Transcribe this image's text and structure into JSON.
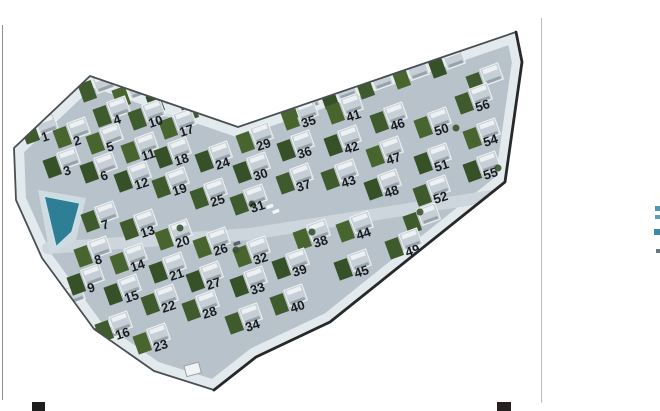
{
  "page": {
    "background": "#ffffff",
    "left_rule": {
      "x": 2,
      "y1": 25,
      "y2": 400,
      "color": "#8f8f8f"
    },
    "right_rule": {
      "x": 541,
      "y1": 18,
      "y2": 403,
      "color": "#bdbdbd"
    },
    "crop_marks": [
      {
        "x": 32,
        "y": 402,
        "w": 13,
        "h": 9,
        "color": "#1e1e1e"
      },
      {
        "x": 497,
        "y": 402,
        "w": 14,
        "h": 9,
        "color": "#262020"
      }
    ],
    "edge_fragments": [
      {
        "x": 655,
        "y": 206,
        "w": 5,
        "h": 5,
        "color": "#4e9aad"
      },
      {
        "x": 655,
        "y": 215,
        "w": 5,
        "h": 4,
        "color": "#5aa2b2"
      },
      {
        "x": 654,
        "y": 229,
        "w": 6,
        "h": 6,
        "color": "#3d8ba0"
      },
      {
        "x": 656,
        "y": 249,
        "w": 4,
        "h": 4,
        "color": "#6b7680"
      }
    ]
  },
  "site_plan": {
    "kind": "aerial-photo-of-villa-development",
    "colors": {
      "paving": "#b7c2ca",
      "paving_light": "#cdd7dd",
      "glow": "#e3eaee",
      "plaza": "#d5dee3",
      "road_light": "#ccd6dc",
      "border": "#4a4f54",
      "border_dark": "#26282a",
      "house": "#c6cfd5",
      "house_trim": "#edf1f3",
      "house_shadow": "#97a2aa",
      "gardens": [
        "#3f5a2d",
        "#49652f",
        "#365128"
      ],
      "pool": "#2e7e95",
      "pool_edge": "#c8e2e8",
      "pool_deck": "#cfdbe0",
      "tree": "#3a5230",
      "building": "#f1f3f4",
      "building_edge": "#9aa4ab",
      "car_light": "#f2f4f6",
      "car_dark": "#5a6168",
      "number": "#191c1f"
    },
    "outline": [
      [
        14,
        148
      ],
      [
        90,
        76
      ],
      [
        238,
        127
      ],
      [
        516,
        32
      ],
      [
        522,
        62
      ],
      [
        505,
        182
      ],
      [
        330,
        322
      ],
      [
        256,
        357
      ],
      [
        214,
        390
      ],
      [
        154,
        371
      ],
      [
        94,
        329
      ],
      [
        42,
        258
      ],
      [
        16,
        200
      ]
    ],
    "dark_edge_indices": [
      3,
      4,
      5,
      6,
      7,
      8
    ],
    "plaza": [
      [
        140,
        90
      ],
      [
        252,
        108
      ],
      [
        236,
        133
      ],
      [
        152,
        113
      ]
    ],
    "central_road": [
      [
        48,
        248
      ],
      [
        250,
        234
      ],
      [
        505,
        194
      ]
    ],
    "pool_deck": [
      [
        38,
        190
      ],
      [
        86,
        198
      ],
      [
        76,
        240
      ],
      [
        50,
        255
      ]
    ],
    "pool": [
      [
        44,
        196
      ],
      [
        80,
        203
      ],
      [
        72,
        232
      ],
      [
        56,
        247
      ]
    ],
    "plots": [
      [
        1,
        43,
        142
      ],
      [
        2,
        75,
        146
      ],
      [
        3,
        65,
        176
      ],
      [
        4,
        115,
        125
      ],
      [
        5,
        108,
        152
      ],
      [
        6,
        102,
        181
      ],
      [
        7,
        103,
        230
      ],
      [
        8,
        96,
        265
      ],
      [
        9,
        89,
        293
      ],
      [
        10,
        150,
        128
      ],
      [
        11,
        143,
        161
      ],
      [
        12,
        136,
        190
      ],
      [
        13,
        142,
        238
      ],
      [
        14,
        132,
        272
      ],
      [
        15,
        126,
        303
      ],
      [
        16,
        117,
        340
      ],
      [
        17,
        181,
        137
      ],
      [
        18,
        176,
        166
      ],
      [
        19,
        174,
        196
      ],
      [
        20,
        177,
        248
      ],
      [
        21,
        171,
        281
      ],
      [
        22,
        163,
        313
      ],
      [
        23,
        155,
        352
      ],
      [
        24,
        217,
        170
      ],
      [
        25,
        212,
        207
      ],
      [
        26,
        215,
        256
      ],
      [
        27,
        208,
        290
      ],
      [
        28,
        204,
        319
      ],
      [
        29,
        258,
        151
      ],
      [
        30,
        255,
        181
      ],
      [
        31,
        252,
        213
      ],
      [
        32,
        255,
        265
      ],
      [
        33,
        252,
        295
      ],
      [
        34,
        247,
        332
      ],
      [
        35,
        303,
        128
      ],
      [
        36,
        299,
        159
      ],
      [
        37,
        298,
        192
      ],
      [
        38,
        315,
        248
      ],
      [
        39,
        294,
        277
      ],
      [
        40,
        292,
        313
      ],
      [
        41,
        348,
        122
      ],
      [
        42,
        346,
        154
      ],
      [
        43,
        343,
        188
      ],
      [
        44,
        358,
        240
      ],
      [
        45,
        356,
        278
      ],
      [
        46,
        392,
        131
      ],
      [
        47,
        388,
        165
      ],
      [
        48,
        386,
        198
      ],
      [
        49,
        407,
        257
      ],
      [
        50,
        436,
        136
      ],
      [
        51,
        436,
        172
      ],
      [
        52,
        435,
        204
      ],
      [
        54,
        485,
        147
      ],
      [
        55,
        485,
        180
      ],
      [
        56,
        477,
        112
      ]
    ],
    "filler_houses": [
      [
        100,
        100
      ],
      [
        134,
        106
      ],
      [
        168,
        112
      ],
      [
        202,
        119
      ],
      [
        305,
        118
      ],
      [
        342,
        107
      ],
      [
        378,
        97
      ],
      [
        414,
        87
      ],
      [
        450,
        76
      ],
      [
        488,
        92
      ],
      [
        70,
        312
      ],
      [
        105,
        348
      ],
      [
        425,
        232
      ]
    ],
    "trees": [
      [
        243,
        122
      ],
      [
        252,
        204
      ],
      [
        312,
        232
      ],
      [
        420,
        212
      ],
      [
        456,
        128
      ],
      [
        498,
        168
      ],
      [
        236,
        250
      ],
      [
        180,
        228
      ]
    ],
    "cars": [
      {
        "x": 266,
        "y": 206,
        "c": "light"
      },
      {
        "x": 272,
        "y": 211,
        "c": "light"
      },
      {
        "x": 233,
        "y": 243,
        "c": "dark"
      }
    ],
    "small_buildings": [
      {
        "x": 184,
        "y": 366,
        "w": 15,
        "h": 11
      }
    ]
  }
}
